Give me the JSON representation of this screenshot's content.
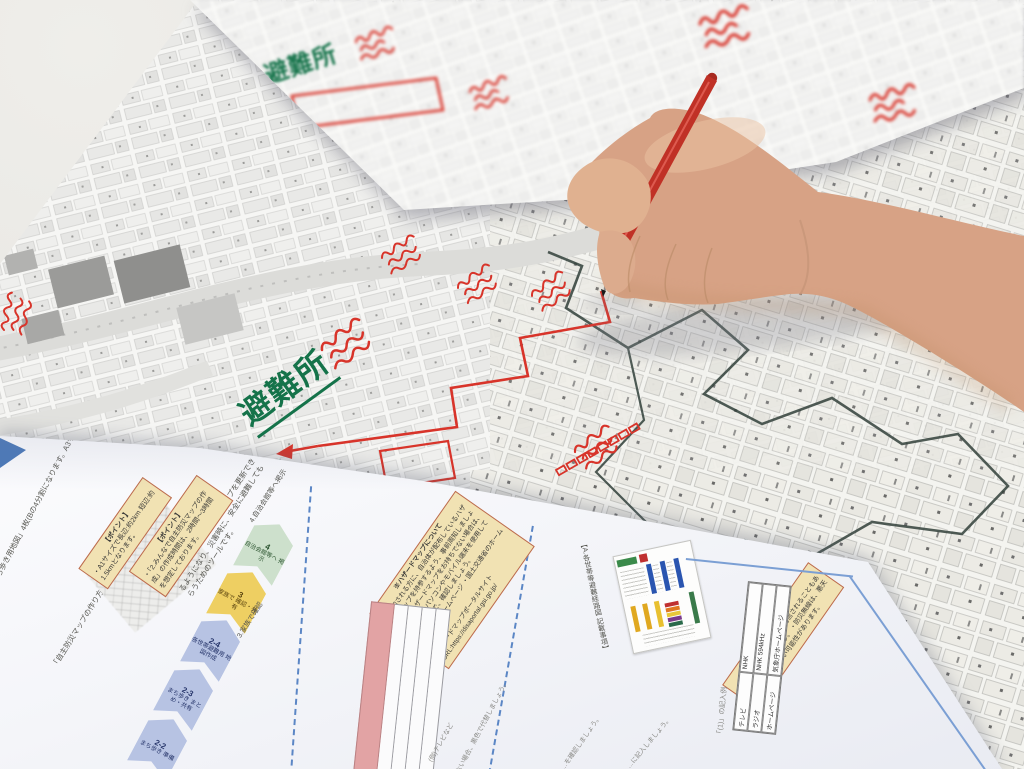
{
  "scene_colors": {
    "desk": "#e8e7e3",
    "map_paper": "#f6f6f4",
    "marker_red": "#d8342a",
    "marker_green": "#15734a",
    "boundary_dark": "#31403a",
    "pen_red": "#c03126",
    "skin": "#d7a285",
    "doc_paper": "#f6f7fa",
    "note_yellow": "#f1e2b3",
    "note_border": "#bc6a4e",
    "flow_blue": "#b7c3e3",
    "flow_yellow": "#eecf62",
    "flow_green": "#cde0cc",
    "table_pink": "#e2a3a4",
    "accent_blue": "#4a78b8"
  },
  "maps": {
    "top_sheet": {
      "evacuation_label": "避難所"
    },
    "main_map": {
      "evacuation_label": "避難所"
    }
  },
  "doc": {
    "left_note_1": "「B.まち歩き用地図」4枚(Bの4分割になります。A3サイズ)",
    "left_note_2": "「自主防災マップの作り方」2枚(本紙)",
    "intro_note": "…のタイミングで自主防災マップを更新できるようになり、災害時に、安全に避難してもらうためのツールです。",
    "point_box_1": {
      "title": "【ポイント】",
      "body": "・A1サイズで長辺:約2km 短辺:約1.5kmとなります。"
    },
    "point_box_2": {
      "title": "【ポイント】",
      "body": "・「2.みんなで自主防災マップの作成」の作成時間は、2時間〜3時間を想定しております。"
    },
    "flow": [
      {
        "num": "2-2",
        "label": "まち歩き 準備"
      },
      {
        "num": "2-3",
        "label": "まち歩き まとめ・共有"
      },
      {
        "num": "2-4",
        "label": "各世帯避難用 地図作成"
      },
      {
        "num": "3",
        "label": "家族で 確認・共有"
      },
      {
        "num": "4",
        "label": "自治会館等へ 掲示"
      }
    ],
    "flow_caption_3": "3.家族で確認",
    "flow_caption_4": "4.自治会館等へ掲示",
    "hazard_box": {
      "title": "※ハザードマップについて",
      "bullet_1": "・参加される方に、自治体が配布しているハザードマップを持参するよう、事前周知しましょう。",
      "bullet_2": "・ハザードマップをお持ちでない場合は、当日ノートパソコンやモバイル端末を使用してWEBページで、確認しましょう。",
      "bullet_3": "・自治体のホームページ ・国土交通省のホームページ",
      "portal": "■ハザードマップポータルサイト",
      "url": "URL:https://disaportal.gsi.go.jp/"
    },
    "sns_box": {
      "title": "【ポイント】",
      "bullet_1": "・SNSなどは誤った情報が発信されることもあるので、注意しましょう。",
      "bullet_2": "・防災無線は、悪天時は、聞き取れない可能性があります。"
    },
    "legend_caption": "【A.各世帯等避難経路図 記載事項】",
    "example_caption": "「(1)」の記入例",
    "info_table": {
      "rows": [
        [
          "テレビ",
          "NHK"
        ],
        [
          "ラジオ",
          "NHK 594kHz"
        ],
        [
          "ホームページ",
          "気象庁ホームページ"
        ]
      ]
    },
    "pink_note_1": "(例)テレビなど",
    "pink_note_2": "色がない場合、黒色で代替しましょう。",
    "bottom_note_1": "…を確認しましょう。",
    "bottom_note_2": "…に記入しましょう。"
  }
}
